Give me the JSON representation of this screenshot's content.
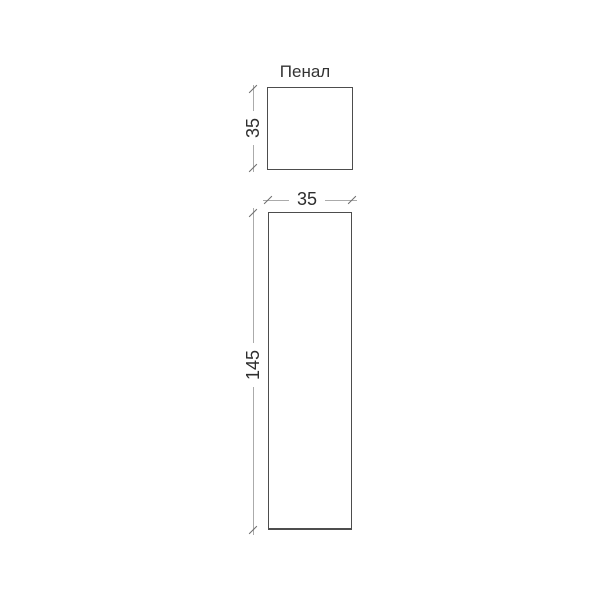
{
  "title": "Пенал",
  "views": {
    "top": {
      "shape": "square",
      "depth_label": "35"
    },
    "front": {
      "shape": "rectangle",
      "width_label": "35",
      "height_label": "145"
    }
  },
  "colors": {
    "background": "#ffffff",
    "outline": "#4d4d4d",
    "dimension_line": "#ababab",
    "tick": "#6e6e6e",
    "text": "#2e2e2e"
  }
}
